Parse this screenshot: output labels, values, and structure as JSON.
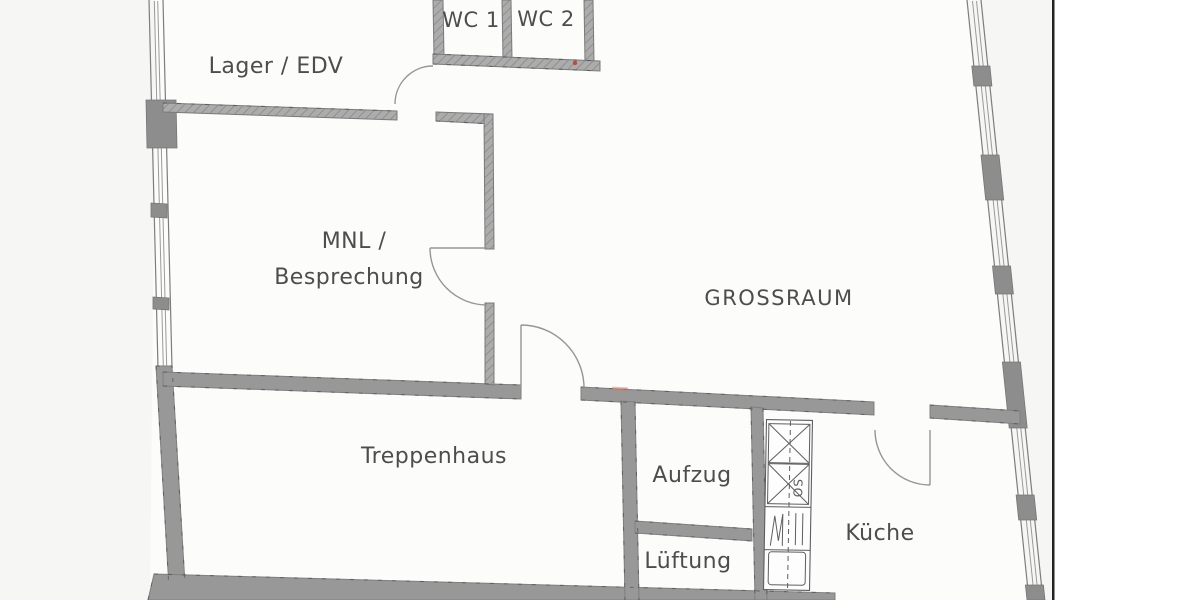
{
  "plan": {
    "rooms": {
      "wc1": "WC 1",
      "wc2": "WC 2",
      "lager": "Lager / EDV",
      "mnl_line1": "MNL /",
      "mnl_line2": "Besprechung",
      "grossraum": "GROSSRAUM",
      "treppenhaus": "Treppenhaus",
      "aufzug": "Aufzug",
      "lueftung": "Lüftung",
      "kueche": "Küche"
    },
    "fixtures": {
      "kitchen_unit_label": "OS"
    },
    "colors": {
      "paper": "#f6f6f4",
      "room_floor": "#fcfcfb",
      "wall_gray": "#989898",
      "pier_gray": "#8d8d8d",
      "line_gray": "#7a7a7a",
      "text_gray": "#4d4d4d",
      "page_edge_black": "#222222",
      "red_mark": "#c0392b"
    }
  }
}
